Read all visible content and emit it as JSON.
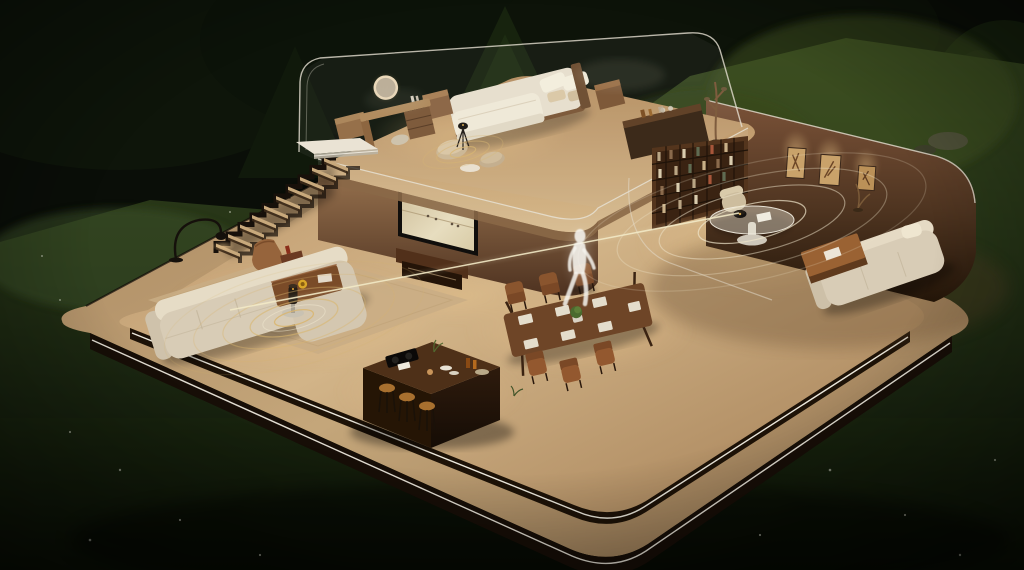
{
  "scene": {
    "description": "Night-time 3D cutaway render of a two-storey smart home on a rounded wooden platform set in a dark forest clearing; smart sensors cast golden concentric coverage rings and a thin detection beam passes through a translucent white human figure walking across the lower floor",
    "time_of_day": "night",
    "environment": {
      "backdrop": "dark forest treeline with tall pine",
      "ground": "moonlit sloping lawn",
      "details": [
        "scattered small white flowers in the grass",
        "boulders beside right-hand tree"
      ]
    },
    "palette": {
      "forest_dark": "#0a0e08",
      "lawn_green": "#33441f",
      "grass_shadow": "#101809",
      "deck_wood": "#bfa077",
      "floor_wood": "#c9ab80",
      "fascia_dark": "#1a1008",
      "led_strip": "#f7f3e8",
      "wall_brown": "#5f4330",
      "bookshelf_wood": "#54351d",
      "sofa_cream": "#d8ccb6",
      "dining_table_wood": "#6e4527",
      "island_wood": "#3a2310",
      "ring_gold": "#d9b56e",
      "ring_white": "#efe6cb",
      "beam_light": "#f2e9c6",
      "person_white": "#f6f4ee",
      "glass_edge": "#e6e0d2",
      "tv_screen_sand": "#ddd0ae",
      "mirror_glow": "#ecd9b8",
      "bowl_yellow": "#d9a728",
      "plant_green": "#4a6a2e"
    },
    "house": {
      "platform": {
        "tiers": 2,
        "edge_lighting": "white LED strip along the dark fascia of both tiers",
        "material": "warm wood deck with rounded corners"
      },
      "upper_floor": {
        "room": "bedroom",
        "enclosure": "frameless glass walls with rounded corners and faint reflections",
        "furniture": [
          "double bed with white duvet and pillows",
          "vanity desk with illuminated round mirror and stool",
          "wooden cube stools and nightstand",
          "floor poufs with tripod smart sensor emitting gold rings",
          "dark sideboard with bottles and glasses",
          "dried branch floor decoration"
        ]
      },
      "staircase": "floating zigzag stair with open risers connecting both floors",
      "lower_floor": {
        "living_area": [
          "L-shaped cream sofa on beige rug",
          "wooden coffee table with yellow bowl",
          "leather lounge chair with ottoman",
          "black arc floor lamp",
          "side table with cylindrical smart speaker emitting gold rings"
        ],
        "media_wall": [
          "wall-mounted TV showing sandy beach scene",
          "wooden media console"
        ],
        "dining_area": [
          "dark wood dining table",
          "six wooden chairs",
          "white place settings",
          "green plant centerpiece"
        ],
        "kitchen": [
          "dark wood island with black cooktop",
          "three bar stools",
          "bottles, dishes and food items"
        ],
        "study": [
          "full-height bookshelf wall",
          "three framed artworks in spot-lit arched niches on curved brown wall",
          "round glass pedestal table with puck-shaped smart sensor",
          "beige armchair",
          "cream sofa with wooden coffee table"
        ]
      }
    },
    "smart_devices": [
      {
        "name": "living-room speaker",
        "effect": "golden concentric sound rings on floor"
      },
      {
        "name": "bedroom tripod sensor",
        "effect": "small golden concentric rings"
      },
      {
        "name": "study table sensor",
        "effect": "wide elliptical white detection rings"
      }
    ],
    "person": {
      "appearance": "translucent glowing white silhouette",
      "action": "walking across the lower floor near the dining area",
      "beam": "thin pale-gold detection beam crossing the room through the figure"
    }
  }
}
